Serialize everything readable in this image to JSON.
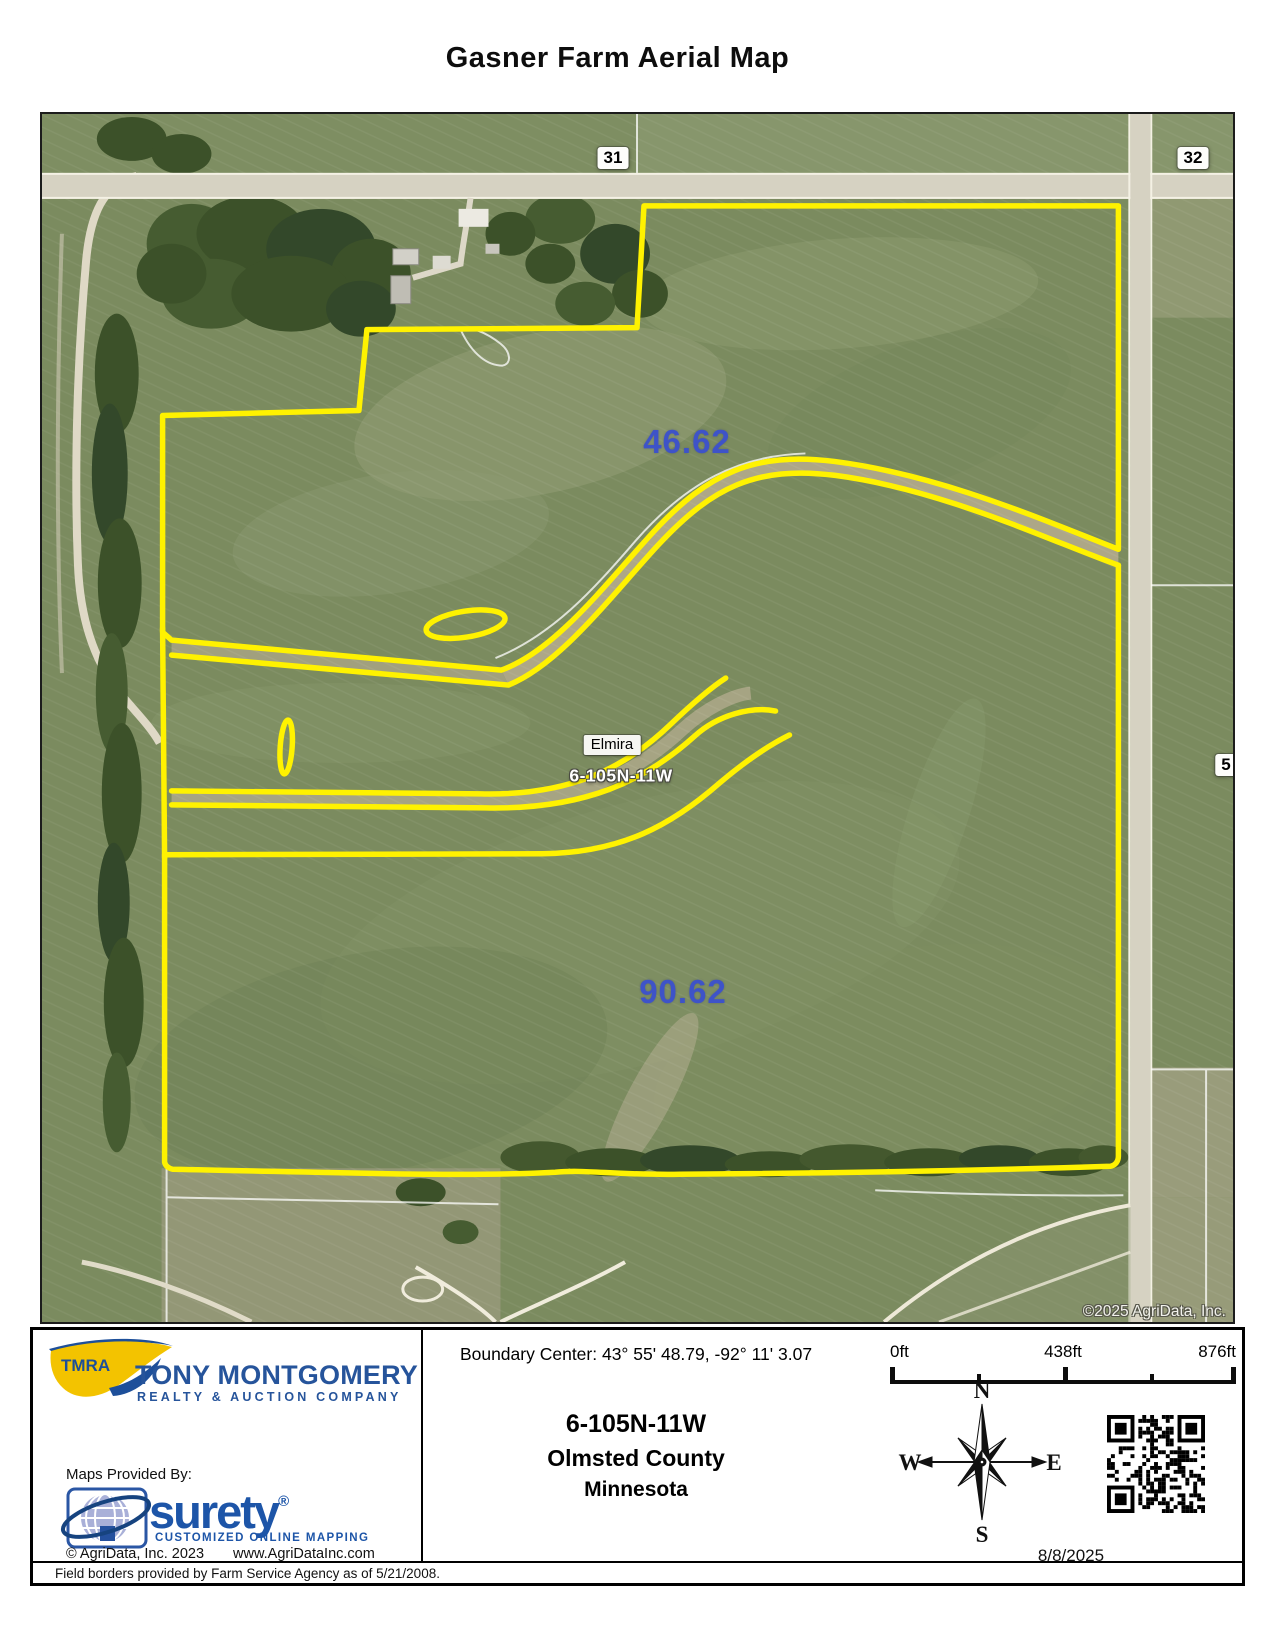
{
  "page": {
    "title": "Gasner Farm Aerial Map"
  },
  "map": {
    "copyright": "©2025 AgriData, Inc.",
    "section_labels": {
      "nw": "31",
      "ne": "32",
      "road": "5"
    },
    "parcels": {
      "north_acres": "46.62",
      "south_acres": "90.62"
    },
    "place": {
      "town": "Elmira",
      "township": "6-105N-11W"
    },
    "colors": {
      "boundary_yellow": "#FFF200",
      "acreage_blue": "#3E53C8"
    }
  },
  "footer": {
    "brand": {
      "badge": "TMRA",
      "company": "TONY MONTGOMERY",
      "tagline": "REALTY & AUCTION COMPANY"
    },
    "boundary_center": "Boundary Center: 43° 55' 48.79,  -92° 11' 3.07",
    "location": {
      "township": "6-105N-11W",
      "county": "Olmsted County",
      "state": "Minnesota"
    },
    "scale": {
      "start": "0ft",
      "middle": "438ft",
      "end": "876ft"
    },
    "compass": {
      "north": "N",
      "east": "E",
      "south": "S",
      "west": "W"
    },
    "provider": {
      "label": "Maps Provided By:",
      "name": "surety",
      "registered": "®",
      "tagline": "CUSTOMIZED ONLINE MAPPING",
      "copyright": "© AgriData, Inc. 2023",
      "website": "www.AgriDataInc.com"
    },
    "date": "8/8/2025",
    "disclaimer": "Field borders provided by Farm Service Agency as of 5/21/2008."
  }
}
